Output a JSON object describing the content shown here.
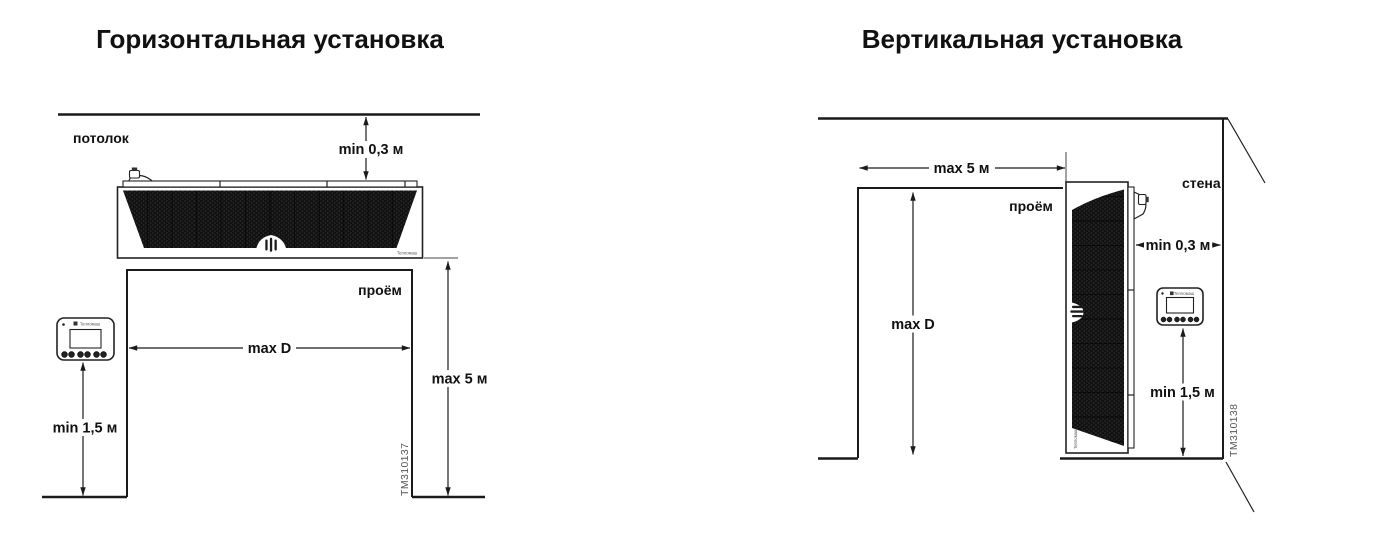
{
  "colors": {
    "background": "#ffffff",
    "line": "#1a1a1a",
    "grille": "#121212",
    "figure_id_text": "#595959"
  },
  "left_diagram": {
    "title": "Горизонтальная установка",
    "ceiling_label": "потолок",
    "opening_label": "проём",
    "dim_ceiling_clearance": "min 0,3 м",
    "dim_opening_width": "max D",
    "dim_opening_height": "max 5 м",
    "dim_panel_height": "min 1,5 м",
    "figure_id": "TM310137",
    "unit_brand": "Тепломаш"
  },
  "right_diagram": {
    "title": "Вертикальная установка",
    "wall_label": "стена",
    "opening_label": "проём",
    "dim_opening_width": "max 5 м",
    "dim_wall_clearance": "min 0,3 м",
    "dim_opening_height": "max D",
    "dim_panel_height": "min 1,5 м",
    "figure_id": "TM310138",
    "unit_brand": "Тепломаш"
  }
}
